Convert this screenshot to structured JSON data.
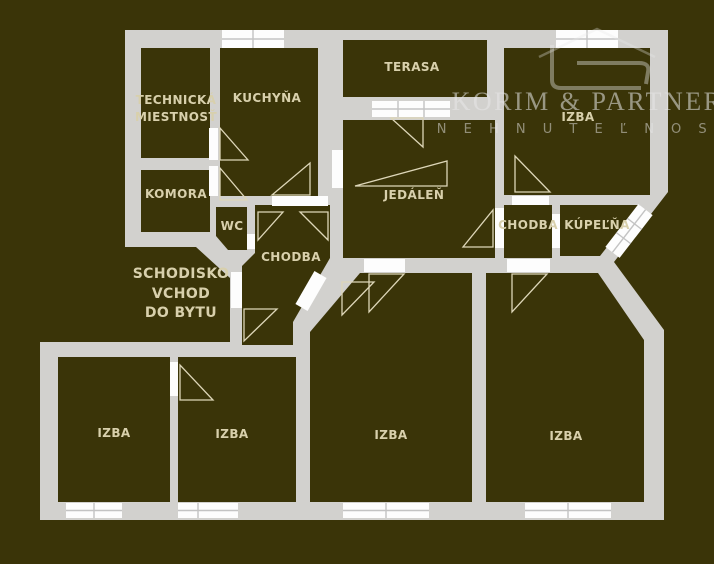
{
  "meta": {
    "description": "Apartment floor plan watermarked by real-estate agency"
  },
  "brand": {
    "name": "KORIM & PARTNERS",
    "subtitle": "N E H N U T E Ľ N O S T I"
  },
  "rooms": {
    "technicka_line1": "TECHNICKÁ",
    "technicka_line2": "MIESTNOSŤ",
    "kuchyna": "KUCHYŇA",
    "terasa": "TERASA",
    "izba_top_right": "IZBA",
    "komora": "KOMORA",
    "wc": "WC",
    "chodba_center": "CHODBA",
    "jedalen": "JEDÁLEŇ",
    "chodba_right": "CHODBA",
    "kupelna": "KÚPEĽŇA",
    "schodisko_line1": "SCHODISKO",
    "schodisko_line2": "VCHOD",
    "schodisko_line3": "DO BYTU",
    "izba_bottom_1": "IZBA",
    "izba_bottom_2": "IZBA",
    "izba_bottom_3": "IZBA",
    "izba_bottom_4": "IZBA"
  },
  "colors": {
    "background": "#3a3408",
    "wall": "#d2d1ce",
    "window": "#fdfdfd",
    "pane": "#c3c3c3",
    "door_line": "#ddd6b8",
    "label": "#d8d0ac",
    "logo": "#e8e8e8"
  }
}
